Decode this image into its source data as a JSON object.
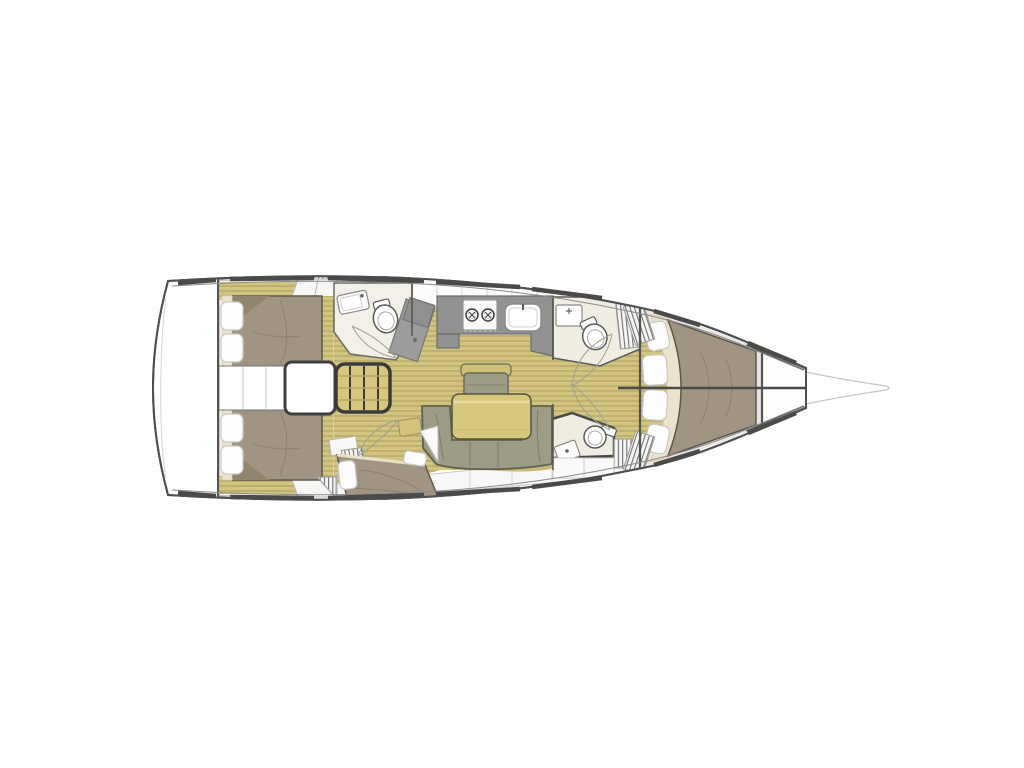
{
  "meta": {
    "type": "floor-plan-diagram",
    "subject": "Sailboat interior layout, top-down plan view, bow pointing right, three-cabin / two-head monohull",
    "canvas": {
      "width": 1024,
      "height": 768
    },
    "background": "#ffffff"
  },
  "colors": {
    "hull_outline": "#4f4f4f",
    "hull_inner_line": "#8a8a8a",
    "hull_fill": "#ffffff",
    "bowsprit_line": "#c6c6c6",
    "deck_panel": "#f4f4f2",
    "deck_panel_line": "#c9c9c7",
    "floor_base": "#d3c57f",
    "floor_stripe": "#b4a565",
    "cabin_bg": "#f5f4f1",
    "bed": "#a29482",
    "bed_fold": "#93866f",
    "bed_crease": "#8d8071",
    "cream_trim": "#ece3cd",
    "pillow": "#fdfdfd",
    "pillow_edge": "#c8c8c6",
    "settee": "#9c9c85",
    "settee_outline": "#60604e",
    "settee_rail": "#c9b87a",
    "bench_back": "#cfbf77",
    "table": "#d8c87e",
    "table_edge": "#57523f",
    "table_stripe": "#e9dca2",
    "counter": "#929292",
    "counter_edge": "#6d6d6b",
    "shower": "#9c9c9c",
    "head_floor": "#f0ede3",
    "fixture_white": "#ffffff",
    "fixture_edge": "#5a5a58",
    "stairs": "#d6c67e",
    "stairs_edge": "#3a3a38",
    "wall_line": "#55534f",
    "door_arc": "#a0a090",
    "louver_bg": "#f6f6f4",
    "louver_line": "#6f6f6f"
  },
  "areas": [
    {
      "name": "transom-stern-locker",
      "description": "white stern area aft of cabins"
    },
    {
      "name": "aft-cabin-port",
      "description": "double berth, 2 pillows, wardrobe, shelf trim"
    },
    {
      "name": "aft-cabin-starboard",
      "description": "double berth, 2 pillows, shelf trim"
    },
    {
      "name": "engine-compartment-corridor",
      "description": "center corridor with engine box between aft cabins"
    },
    {
      "name": "companionway-steps",
      "description": "4-tread stair to cockpit"
    },
    {
      "name": "aft-head",
      "description": "sink, toilet, separate shower stall"
    },
    {
      "name": "galley",
      "description": "L-counter with 2-burner stove and sink, overhead lockers"
    },
    {
      "name": "saloon",
      "description": "U-settee, folding table, forward bench seat, side shelf"
    },
    {
      "name": "midship-single-berth",
      "description": "diagonal single berth with 2 pillows"
    },
    {
      "name": "forward-head-port",
      "description": "sink and toilet with louvered locker"
    },
    {
      "name": "forward-head-starboard",
      "description": "sink and toilet with louvered locker"
    },
    {
      "name": "forward-cabin",
      "description": "V-berth double bed, 4 pillows, cream headboard trim"
    },
    {
      "name": "anchor-locker",
      "description": "white bow compartment"
    },
    {
      "name": "bowsprit",
      "description": "faint tapering prow outline at bow tip"
    }
  ],
  "fixture_counts": {
    "double_beds": 3,
    "single_berths": 1,
    "pillows": 10,
    "toilets": 3,
    "head_sinks": 3,
    "galley_sinks": 1,
    "stove_burners": 2,
    "heads_with_shower": 1
  }
}
